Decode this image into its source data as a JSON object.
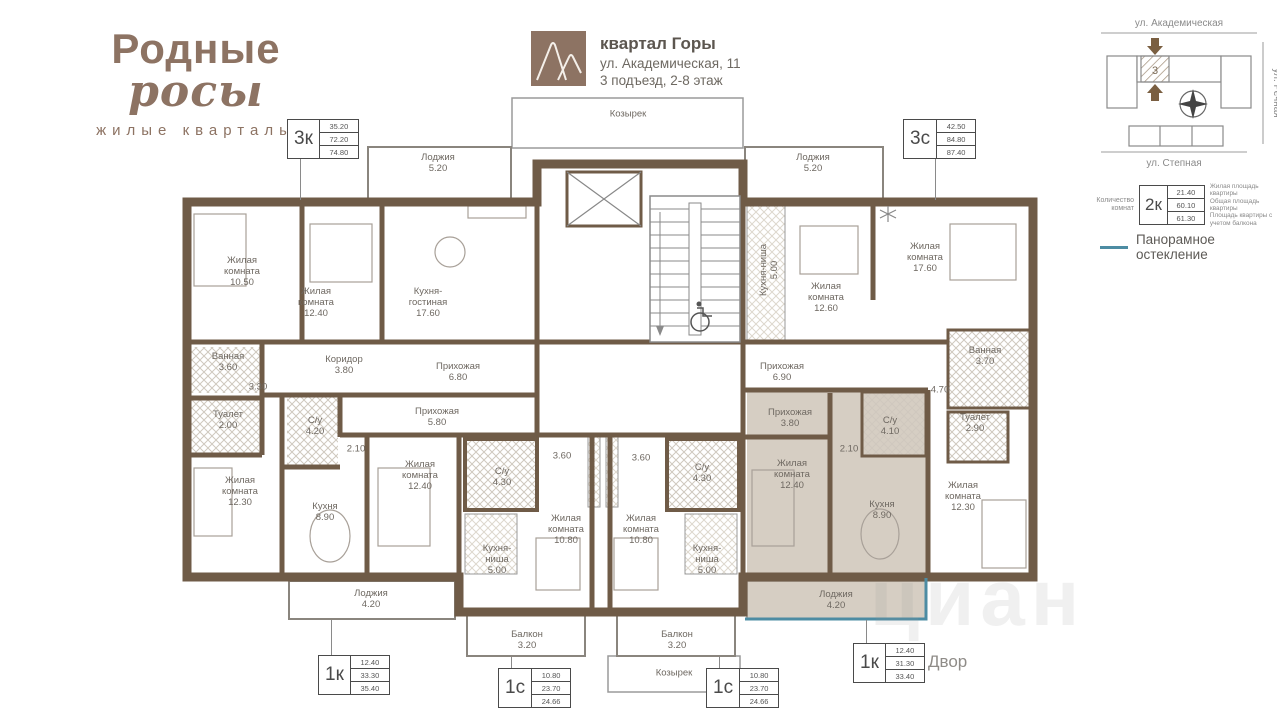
{
  "colors": {
    "walls": "#6f5b47",
    "highlight": "#d6cec3",
    "brand": "#8d7363",
    "glazing": "#4d8ca3"
  },
  "brand": {
    "title_main": "Родные",
    "title_script": "росы",
    "subtitle": "жилые кварталы"
  },
  "header": {
    "quarter": "квартал Горы",
    "address": "ул. Академическая, 11",
    "entrance": "3 подъезд, 2-8 этаж"
  },
  "site_map": {
    "street_top": "ул. Академическая",
    "street_right": "ул. Речная",
    "street_bottom": "ул. Степная",
    "section_label": "3"
  },
  "legend": {
    "rooms_count_label": "Количество комнат",
    "sample_type": "2к",
    "rows": [
      {
        "value": "21.40",
        "label": "Жилая площадь квартиры"
      },
      {
        "value": "60.10",
        "label": "Общая площадь квартиры"
      },
      {
        "value": "61.30",
        "label": "Площадь квартиры с учетом балкона"
      }
    ],
    "glazing_label": "Панорамное остекление",
    "glazing_color": "#4d8ca3"
  },
  "plan": {
    "yard_label": "Двор",
    "watermark": "циан",
    "apartment_tags": [
      {
        "type": "3к",
        "values": [
          "35.20",
          "72.20",
          "74.80"
        ],
        "x": 287,
        "y": 119,
        "leader": {
          "x": 300,
          "y1": 159,
          "y2": 200
        }
      },
      {
        "type": "3с",
        "values": [
          "42.50",
          "84.80",
          "87.40"
        ],
        "x": 903,
        "y": 119,
        "leader": {
          "x": 935,
          "y1": 159,
          "y2": 200
        }
      },
      {
        "type": "1к",
        "values": [
          "12.40",
          "33.30",
          "35.40"
        ],
        "x": 318,
        "y": 655,
        "leader": {
          "x": 331,
          "y1": 620,
          "y2": 655
        }
      },
      {
        "type": "1с",
        "values": [
          "10.80",
          "23.70",
          "24.66"
        ],
        "x": 498,
        "y": 668,
        "leader": {
          "x": 511,
          "y1": 657,
          "y2": 668
        }
      },
      {
        "type": "1с",
        "values": [
          "10.80",
          "23.70",
          "24.66"
        ],
        "x": 706,
        "y": 668,
        "leader": {
          "x": 719,
          "y1": 657,
          "y2": 668
        }
      },
      {
        "type": "1к",
        "values": [
          "12.40",
          "31.30",
          "33.40"
        ],
        "x": 853,
        "y": 643,
        "leader": {
          "x": 866,
          "y1": 620,
          "y2": 643
        }
      }
    ],
    "labels": [
      {
        "t": "Лоджия\n5.20",
        "x": 438,
        "y": 163
      },
      {
        "t": "Жилая\nкомната\n10.50",
        "x": 242,
        "y": 272
      },
      {
        "t": "Жилая\nкомната\n12.40",
        "x": 316,
        "y": 303
      },
      {
        "t": "Кухня-\nгостиная\n17.60",
        "x": 428,
        "y": 303
      },
      {
        "t": "Ванная\n3.60",
        "x": 228,
        "y": 362
      },
      {
        "t": "3.30",
        "x": 258,
        "y": 387
      },
      {
        "t": "Коридор\n3.80",
        "x": 344,
        "y": 365
      },
      {
        "t": "Прихожая\n6.80",
        "x": 458,
        "y": 372
      },
      {
        "t": "Туалет\n2.00",
        "x": 228,
        "y": 420
      },
      {
        "t": "Жилая\nкомната\n12.30",
        "x": 240,
        "y": 492
      },
      {
        "t": "С/у\n4.20",
        "x": 315,
        "y": 426
      },
      {
        "t": "Прихожая\n5.80",
        "x": 437,
        "y": 417
      },
      {
        "t": "2.10",
        "x": 356,
        "y": 449
      },
      {
        "t": "Кухня\n8.90",
        "x": 325,
        "y": 512
      },
      {
        "t": "Жилая\nкомната\n12.40",
        "x": 420,
        "y": 476
      },
      {
        "t": "Лоджия\n4.20",
        "x": 371,
        "y": 599
      },
      {
        "t": "3.60",
        "x": 562,
        "y": 456
      },
      {
        "t": "С/у\n4.30",
        "x": 502,
        "y": 477
      },
      {
        "t": "Жилая\nкомната\n10.80",
        "x": 566,
        "y": 530
      },
      {
        "t": "Кухня-\nниша\n5.00",
        "x": 497,
        "y": 560
      },
      {
        "t": "Балкон\n3.20",
        "x": 527,
        "y": 640
      },
      {
        "t": "3.60",
        "x": 641,
        "y": 458
      },
      {
        "t": "С/у\n4.30",
        "x": 702,
        "y": 473
      },
      {
        "t": "Жилая\nкомната\n10.80",
        "x": 641,
        "y": 530
      },
      {
        "t": "Кухня-\nниша\n5.00",
        "x": 707,
        "y": 560
      },
      {
        "t": "Балкон\n3.20",
        "x": 677,
        "y": 640
      },
      {
        "t": "Козырек",
        "x": 628,
        "y": 114
      },
      {
        "t": "Козырек",
        "x": 674,
        "y": 673
      },
      {
        "t": "Лоджия\n5.20",
        "x": 813,
        "y": 163
      },
      {
        "t": "Кухня-ниша\n5.00",
        "x": 769,
        "y": 270,
        "v": true
      },
      {
        "t": "Жилая\nкомната\n12.60",
        "x": 826,
        "y": 298
      },
      {
        "t": "Жилая\nкомната\n17.60",
        "x": 925,
        "y": 258
      },
      {
        "t": "Прихожая\n6.90",
        "x": 782,
        "y": 372
      },
      {
        "t": "Ванная\n3.70",
        "x": 985,
        "y": 356
      },
      {
        "t": "4.70",
        "x": 940,
        "y": 390
      },
      {
        "t": "Прихожая\n3.80",
        "x": 790,
        "y": 418
      },
      {
        "t": "Жилая\nкомната\n12.40",
        "x": 792,
        "y": 475
      },
      {
        "t": "2.10",
        "x": 849,
        "y": 449
      },
      {
        "t": "С/у\n4.10",
        "x": 890,
        "y": 426
      },
      {
        "t": "Туалет\n2.90",
        "x": 975,
        "y": 423
      },
      {
        "t": "Кухня\n8.90",
        "x": 882,
        "y": 510
      },
      {
        "t": "Жилая\nкомната\n12.30",
        "x": 963,
        "y": 497
      },
      {
        "t": "Лоджия\n4.20",
        "x": 836,
        "y": 600
      }
    ]
  }
}
